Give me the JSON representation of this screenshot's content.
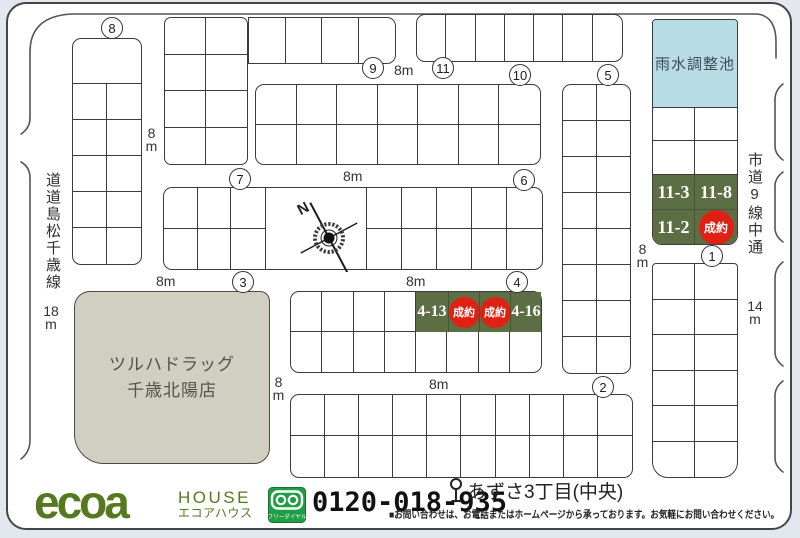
{
  "map": {
    "pond": {
      "label": "雨水調整池"
    },
    "building": {
      "line1": "ツルハドラッグ",
      "line2": "千歳北陽店"
    },
    "roads": {
      "left_name": "道道島松千歳線",
      "left_width": "18m",
      "right_name": "市道9線中通",
      "right_width": "14m",
      "standard_width": "8m"
    },
    "compass": {
      "label": "N"
    },
    "markers": {
      "b1": "1",
      "b2": "2",
      "b3": "3",
      "b4": "4",
      "b5": "5",
      "b6": "6",
      "b7": "7",
      "b8": "8",
      "b9": "9",
      "b10": "10",
      "b11": "11"
    },
    "sold_label": "成約",
    "lots": {
      "block11": [
        {
          "id": "11-3",
          "status": "available"
        },
        {
          "id": "11-8",
          "status": "available"
        },
        {
          "id": "11-2",
          "status": "available"
        },
        {
          "id": "",
          "status": "sold"
        }
      ],
      "block4": [
        {
          "id": "4-13",
          "status": "available"
        },
        {
          "id": "",
          "status": "sold"
        },
        {
          "id": "",
          "status": "sold"
        },
        {
          "id": "4-16",
          "status": "available"
        }
      ]
    },
    "colors": {
      "lot_green": "#5c6e44",
      "sold_red": "#df2114",
      "pond_blue": "#b8dce6",
      "building_beige": "#d1cec2"
    }
  },
  "footer": {
    "brand": "ecoa",
    "brand_sub": "HOUSE",
    "brand_kana": "エコアハウス",
    "freedial": "フリーダイヤル",
    "phone": "0120-018-935",
    "bus_stop": "あずさ3丁目(中央)",
    "notice": "■お問い合わせは、お電話またはホームページから承っております。お気軽にお問い合わせください。"
  }
}
